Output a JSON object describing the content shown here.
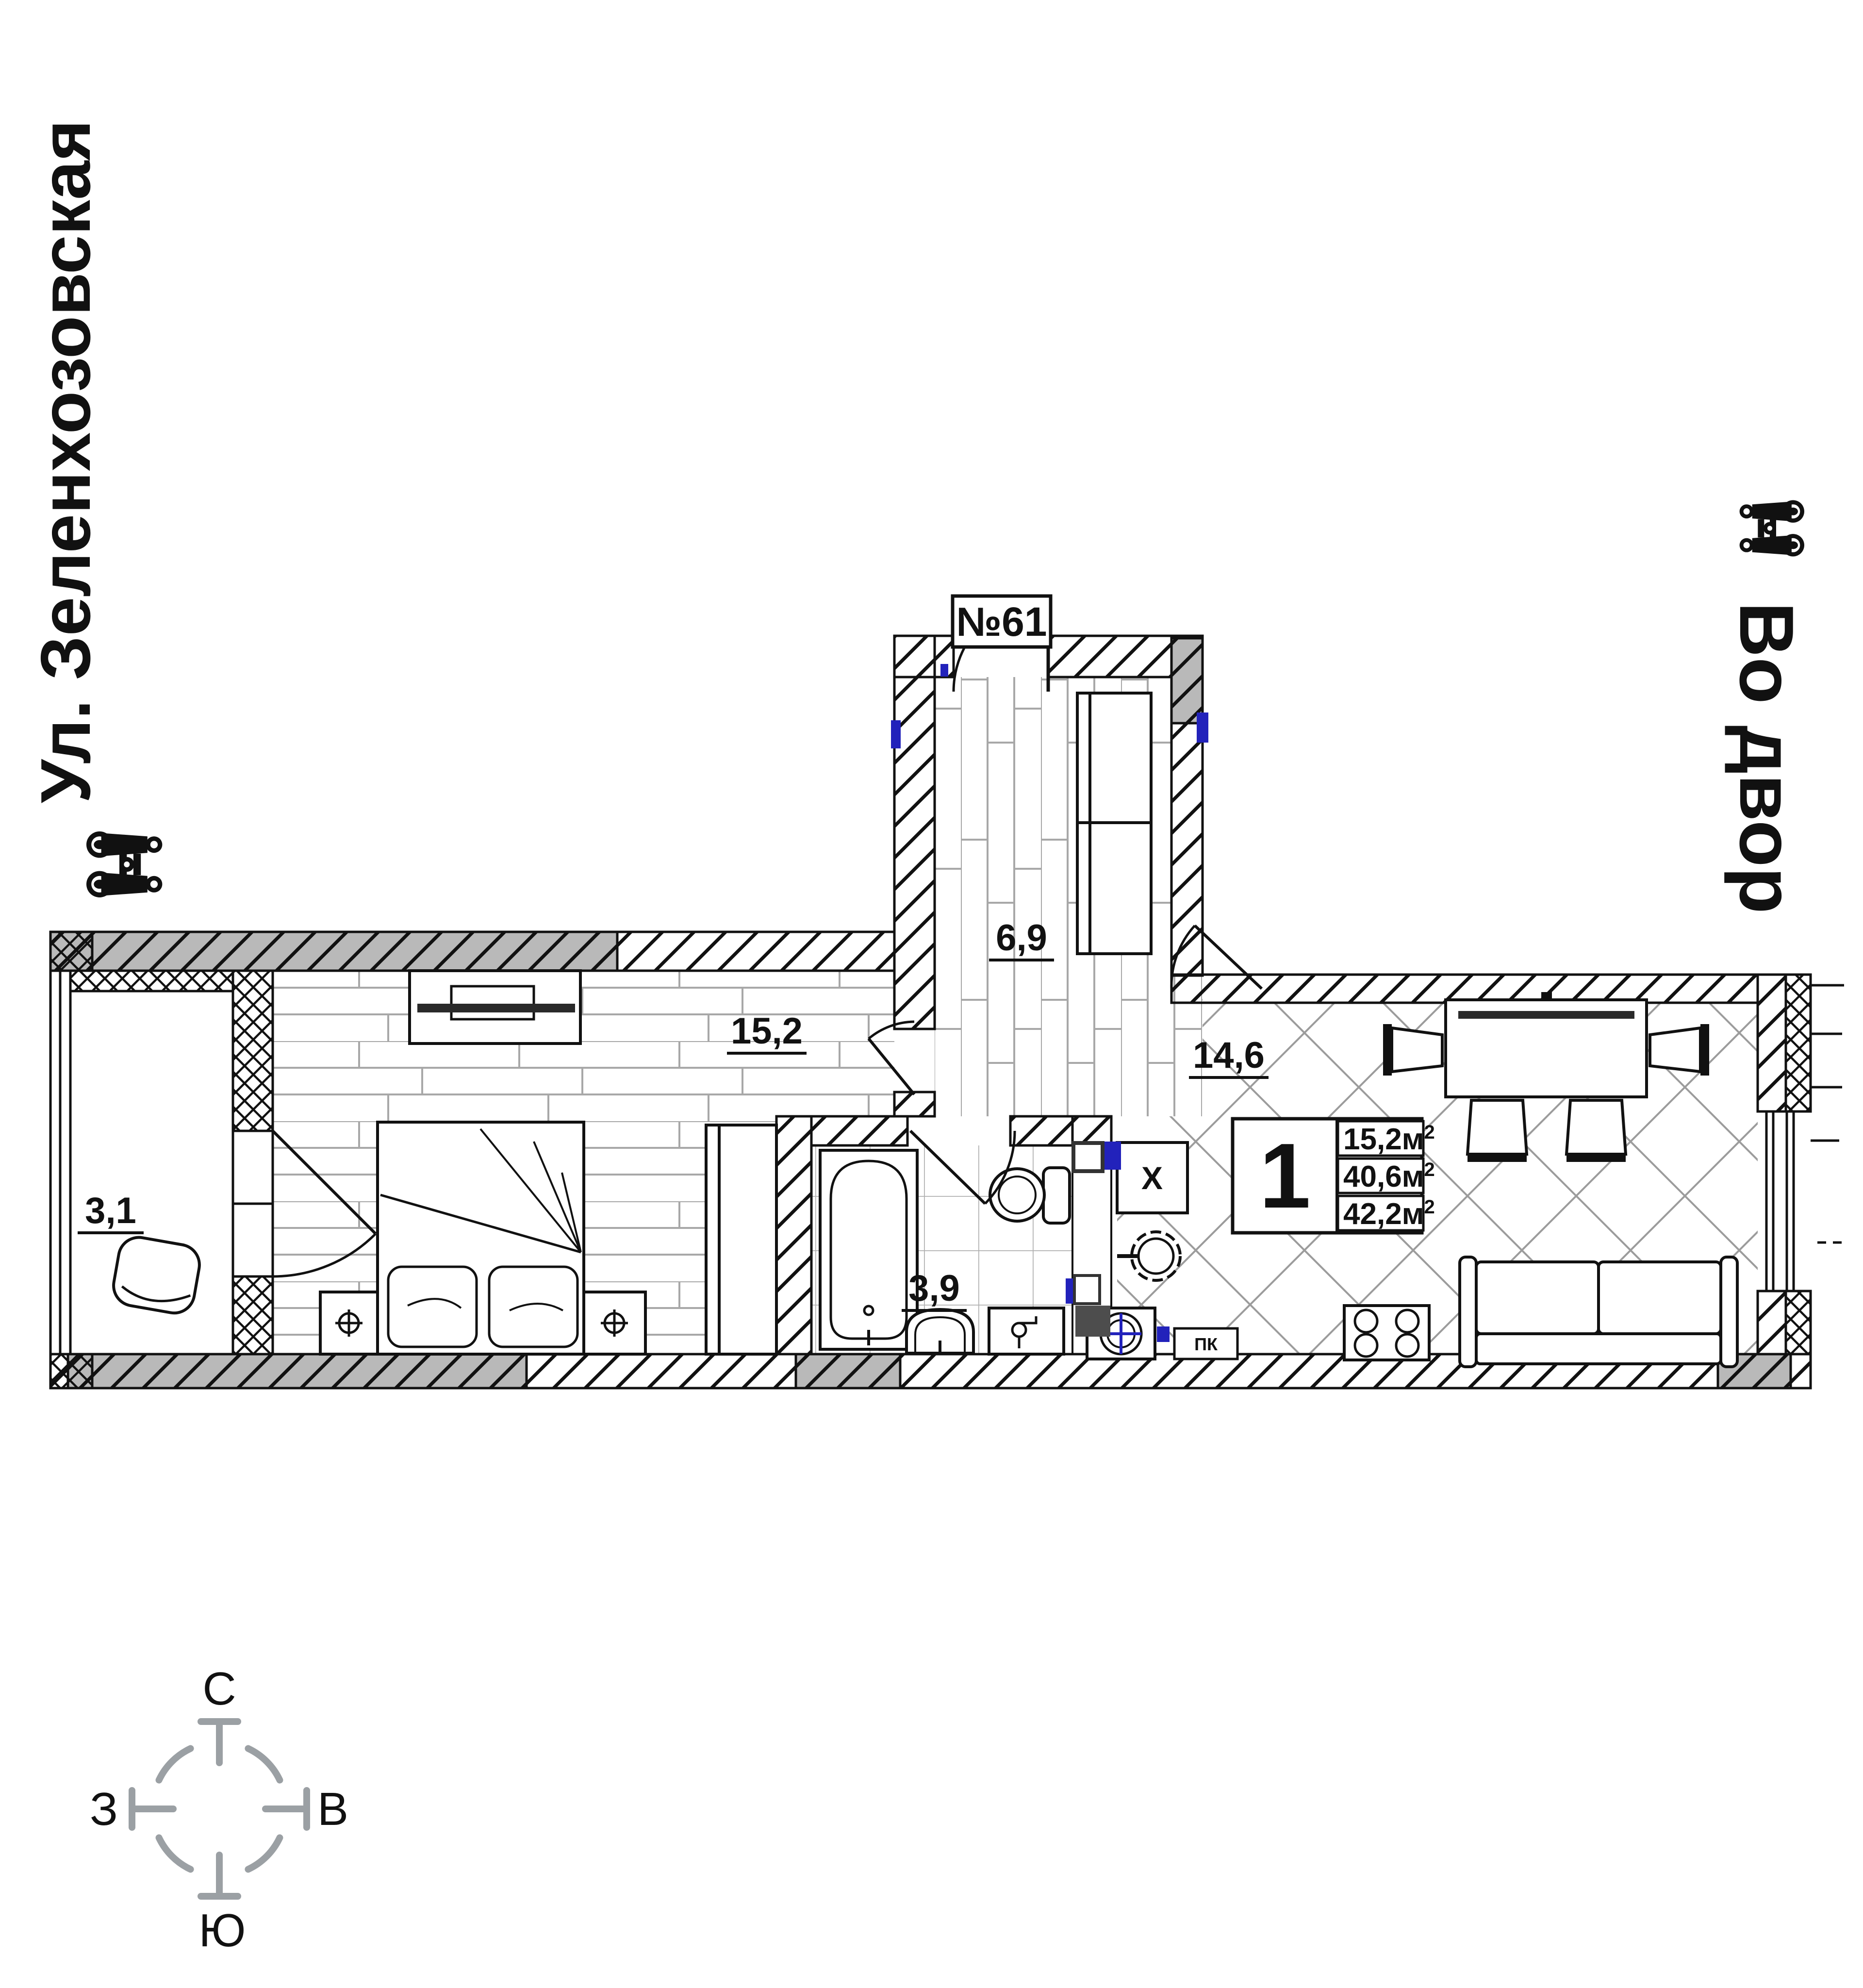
{
  "page": {
    "background": "#ffffff"
  },
  "orientation_labels": {
    "left_street": {
      "text": "Ул. Зеленхозовская",
      "icon": "binoculars-icon"
    },
    "right_courtyard": {
      "text": "Во двор",
      "icon": "binoculars-icon"
    }
  },
  "apartment": {
    "number": "№61",
    "rooms": {
      "hall_area": "6,9",
      "bedroom_area": "15,2",
      "kitchen_living_area": "14,6",
      "bathroom_area": "3,9",
      "balcony_area": "3,1"
    },
    "info_box": {
      "rooms_count": "1",
      "areas": [
        {
          "value": "15,2м",
          "sup": "2"
        },
        {
          "value": "40,6м",
          "sup": "2"
        },
        {
          "value": "42,2м",
          "sup": "2"
        }
      ]
    },
    "marks": {
      "vent_shaft": "X",
      "fire_cabinet": "ПК"
    }
  },
  "compass": {
    "north": "С",
    "east": "В",
    "south": "Ю",
    "west": "З",
    "color": "#9ba0a4"
  },
  "colors": {
    "wall_gray": "#b9b9b9",
    "accent_blue": "#2222bb",
    "dark_box": "#4d4d4d",
    "line_black": "#111111",
    "floor_line_gray": "#a0a0a0"
  }
}
